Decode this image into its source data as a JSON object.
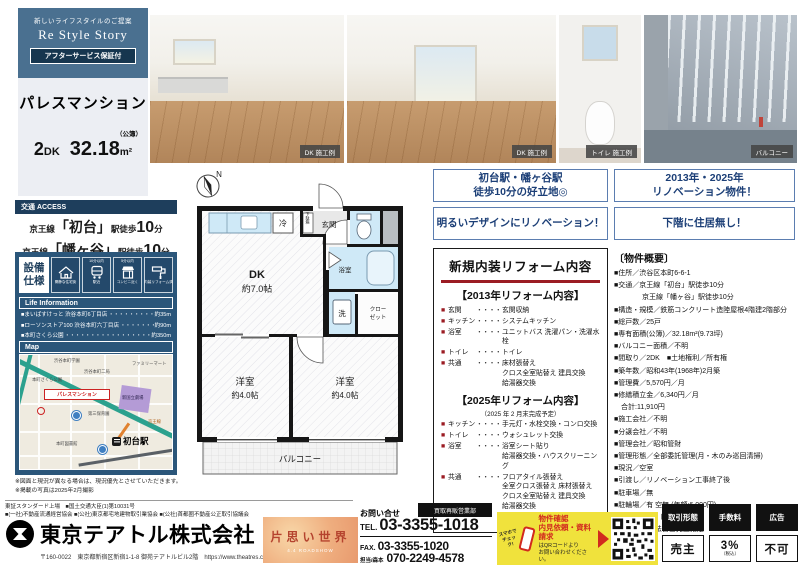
{
  "colors": {
    "header_blue": "#4a7090",
    "panel_navy": "#2b567a",
    "access_navy": "#1e3e5c",
    "badge_navy": "#16364f",
    "accent_red": "#9b1c23",
    "highlight_navy": "#1c3f77",
    "qr_yellow": "#f0e23c",
    "qr_red": "#d22a1e",
    "map_green_road": "#2ba18e"
  },
  "left": {
    "header": {
      "tagline": "新しいライフスタイルのご提案",
      "brand": "Re Style Story",
      "badge": "アフターサービス保証付",
      "property_name": "パレスマンション",
      "layout_num": "2",
      "layout_unit": "DK",
      "area_num": "32.18",
      "area_unit": "m²",
      "area_note": "（公簿）"
    },
    "access": {
      "label": "交通 ACCESS",
      "lines": [
        {
          "railway": "京王線",
          "station": "「初台」",
          "suffix": "駅徒歩",
          "min": "10",
          "unit": "分"
        },
        {
          "railway": "京王線",
          "station": "「幡ヶ谷」",
          "suffix": "駅徒歩",
          "min": "10",
          "unit": "分"
        }
      ]
    },
    "features": {
      "label": "設備仕様",
      "items": [
        {
          "badge": "",
          "caption": "閑静な住宅街"
        },
        {
          "badge": "10分以内",
          "caption": "駅近"
        },
        {
          "badge": "5分以内",
          "caption": "コンビニ近く"
        },
        {
          "badge": "",
          "caption": "内装リフォーム済"
        }
      ]
    },
    "life_info": {
      "label": "Life Information",
      "items": [
        {
          "name": "■まいばすけっと 渋谷本町6丁目店",
          "dots": "・・・・・・・・・・・・・・",
          "distance": "約35m"
        },
        {
          "name": "■ローソンストア100 渋谷本町六丁目店",
          "dots": "・・・・・・・・・・",
          "distance": "約90m"
        },
        {
          "name": "■本町さくら公園",
          "dots": "・・・・・・・・・・・・・・・・・・・・",
          "distance": "約350m"
        }
      ]
    },
    "map": {
      "label": "Map",
      "property_label": "パレスマンション",
      "station_label": "初台駅",
      "landmarks": [
        "渋谷本町学園",
        "本町さくら公園",
        "渋谷本町二局",
        "ファミリーマート",
        "新国立劇場",
        "第三保育園",
        "本町図書館",
        "京王線"
      ]
    },
    "notes": [
      "※図面と現況が異なる場合は、現況優先とさせていただきます。",
      "※掲載の写真は2025年2月撮影"
    ]
  },
  "photos": [
    {
      "caption": "DK 施工例"
    },
    {
      "caption": "DK 施工例"
    },
    {
      "caption": "トイレ 施工例"
    },
    {
      "caption": "バルコニー"
    }
  ],
  "floorplan": {
    "north": "N",
    "dk": "DK",
    "dk_size": "約7.0帖",
    "genkan": "玄関",
    "getabako": "下駄箱",
    "fridge": "冷",
    "bath": "浴室",
    "wash": "洗",
    "closet1": "クロー",
    "closet2": "ゼット",
    "west1": "洋室",
    "west1_size": "約4.0帖",
    "west2": "洋室",
    "west2_size": "約4.0帖",
    "balcony": "バルコニー"
  },
  "highlights": [
    "初台駅・幡ヶ谷駅\n徒歩10分の好立地◎",
    "2013年・2025年\nリノベーション物件！",
    "明るいデザインにリノベーション！",
    "下階に住居無し！"
  ],
  "reform": {
    "title": "新規内装リフォーム内容",
    "bullet": "■",
    "dots": "・・・・・・・・・・・・",
    "sections": [
      {
        "heading": "【2013年リフォーム内容】",
        "note": "",
        "rows": [
          {
            "label": "玄関",
            "value": "玄関収納"
          },
          {
            "label": "キッチン",
            "value": "システムキッチン"
          },
          {
            "label": "浴室",
            "value": "ユニットバス 洗濯パン・洗濯水栓"
          },
          {
            "label": "トイレ",
            "value": "トイレ"
          },
          {
            "label": "共通",
            "value": "床材張替え\nクロス全室貼替え 建具交換\n給湯器交換"
          }
        ]
      },
      {
        "heading": "【2025年リフォーム内容】",
        "note": "（2025 年 2 月末完成予定）",
        "rows": [
          {
            "label": "キッチン",
            "value": "手元灯・水栓交換・コンロ交換"
          },
          {
            "label": "トイレ",
            "value": "ウォシュレット交換"
          },
          {
            "label": "浴室",
            "value": "浴室シート貼り\n給湯器交換・ハウスクリーニング"
          },
          {
            "label": "共通",
            "value": "フロアタイル張替え\n全室クロス張替え 床材張替え\nクロス全室貼替え 建具交換\n給湯器交換"
          }
        ]
      }
    ]
  },
  "overview": {
    "title": "〔物件概要〕",
    "rows": [
      "■住所／渋谷区本町6-6-1",
      "■交通／京王線「初台」駅徒歩10分",
      "　　　　京王線「幡ヶ谷」駅徒歩10分",
      "■構造・規模／鉄筋コンクリート造陸屋根4階建2階部分",
      "■総戸数／25戸",
      "■専有面積(公簿)／32.18m²(9.73坪)",
      "■バルコニー面積／不明",
      "■間取り／2DK　■土地権利／所有権",
      "■築年数／昭和43年(1968年)2月築",
      "■管理費／5,570円／月",
      "■修繕積立金／6,340円／月",
      "　合計:11,910円",
      "■施工会社／不明",
      "■分譲会社／不明",
      "■管理会社／昭和管財",
      "■管理形態／全部委託管理(月・木のみ巡回清掃)",
      "■現況／空室",
      "■引渡し／リノベーション工事終了後",
      "■駐車場／無",
      "■駐輪場／有 空無 (年額:6,000円)",
      "■備考／※ペット飼育不可",
      "　　　　※司法書士売主指定"
    ]
  },
  "footer": {
    "listing_line1": "東証スタンダード上場　■国土交通大臣(1)第10031号",
    "listing_line2": "■(一社)不動産流通経営協会 ■(公社)東京都宅地建物取引業協会 ■(公社)首都圏不動産公正取引協議会",
    "company": "東京テアトル株式会社",
    "address": "〒160-0022　東京都新宿区新宿1-1-8 御苑テアトルビル2階　https://www.theatres.co.jp",
    "ad_title": "片思い世界",
    "ad_sub": "4.4 ROADSHOW",
    "contact": {
      "inquiry": "お問い合せ",
      "dept": "買取再販営業部",
      "tel_label": "TEL.",
      "tel": "03-3355-1018",
      "fax_label": "FAX.",
      "fax": "03-3355-1020",
      "mobile_label": "担当/森本",
      "mobile": "070-2249-4578"
    },
    "qr": {
      "hand_note": "スマホで\nチェック!",
      "title": "物件確認\n内見依頼・資料請求",
      "body": "はQRコードより\nお問い合わせください。"
    },
    "deal": {
      "headers": [
        "取引形態",
        "手数料",
        "広告"
      ],
      "values": [
        "売主",
        "3%",
        "不可"
      ],
      "fee_note": "（税込）"
    }
  }
}
